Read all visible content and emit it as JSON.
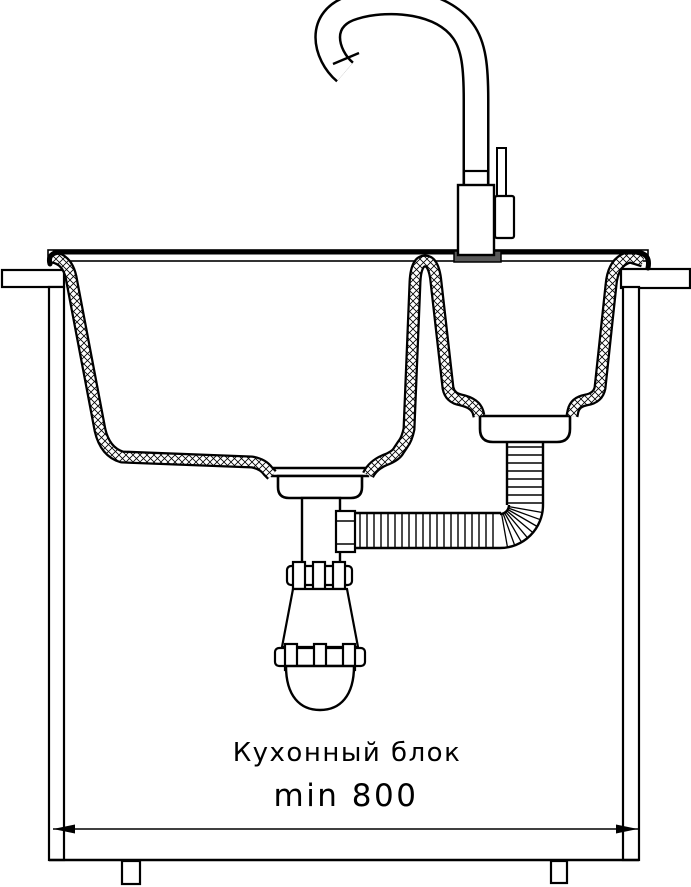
{
  "diagram": {
    "caption": "Кухонный блок",
    "dimension_label": "min 800",
    "colors": {
      "line": "#000000",
      "background": "#ffffff",
      "faucet_base": "#595959"
    },
    "components": {
      "faucet": "gooseneck-kitchen-faucet",
      "sink": "double-bowl-inset-sink",
      "main_bowl": "deep-main-bowl",
      "secondary_bowl": "small-secondary-bowl",
      "trap": "bottle-siphon-trap",
      "hose": "corrugated-drain-hose",
      "cabinet": "kitchen-base-cabinet",
      "countertop": "worktop",
      "dimension": "min-width-dimension-line"
    }
  }
}
